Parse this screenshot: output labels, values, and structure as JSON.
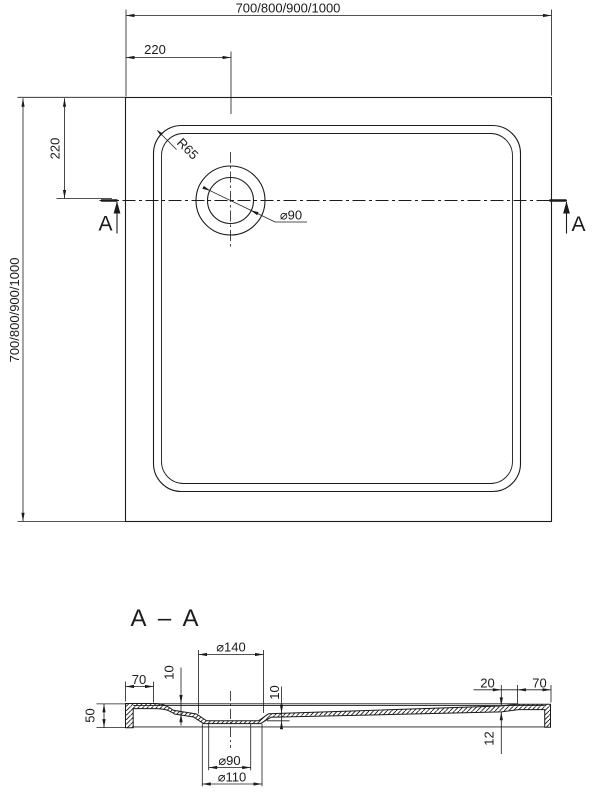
{
  "drawing": {
    "background_color": "#ffffff",
    "line_color": "#1b1b1b",
    "plan_view": {
      "width_dim": "700/800/900/1000",
      "height_dim": "700/800/900/1000",
      "drain_offset_top": "220",
      "drain_offset_left": "220",
      "corner_radius": "R65",
      "drain_diameter": "⌀90",
      "section_marker_left": "A",
      "section_marker_right": "A"
    },
    "section_view": {
      "title": "A – A",
      "recess_top_diameter": "⌀140",
      "left_flange_width": "70",
      "left_step_height": "10",
      "recess_depth": "10",
      "overall_height": "50",
      "right_step_width": "20",
      "right_flange_width": "70",
      "right_edge_thickness": "12",
      "drain_hole_diameter": "⌀90",
      "recess_bottom_diameter": "⌀110"
    }
  }
}
